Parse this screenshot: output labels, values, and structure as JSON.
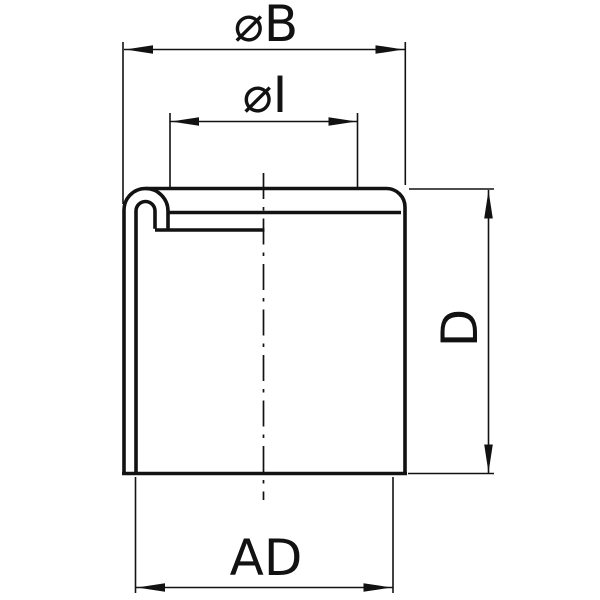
{
  "colors": {
    "background": "#ffffff",
    "line": "#121212"
  },
  "labels": {
    "outer_diameter": "⌀B",
    "inner_diameter": "⌀I",
    "height": "D",
    "fit_diameter": "AD"
  }
}
